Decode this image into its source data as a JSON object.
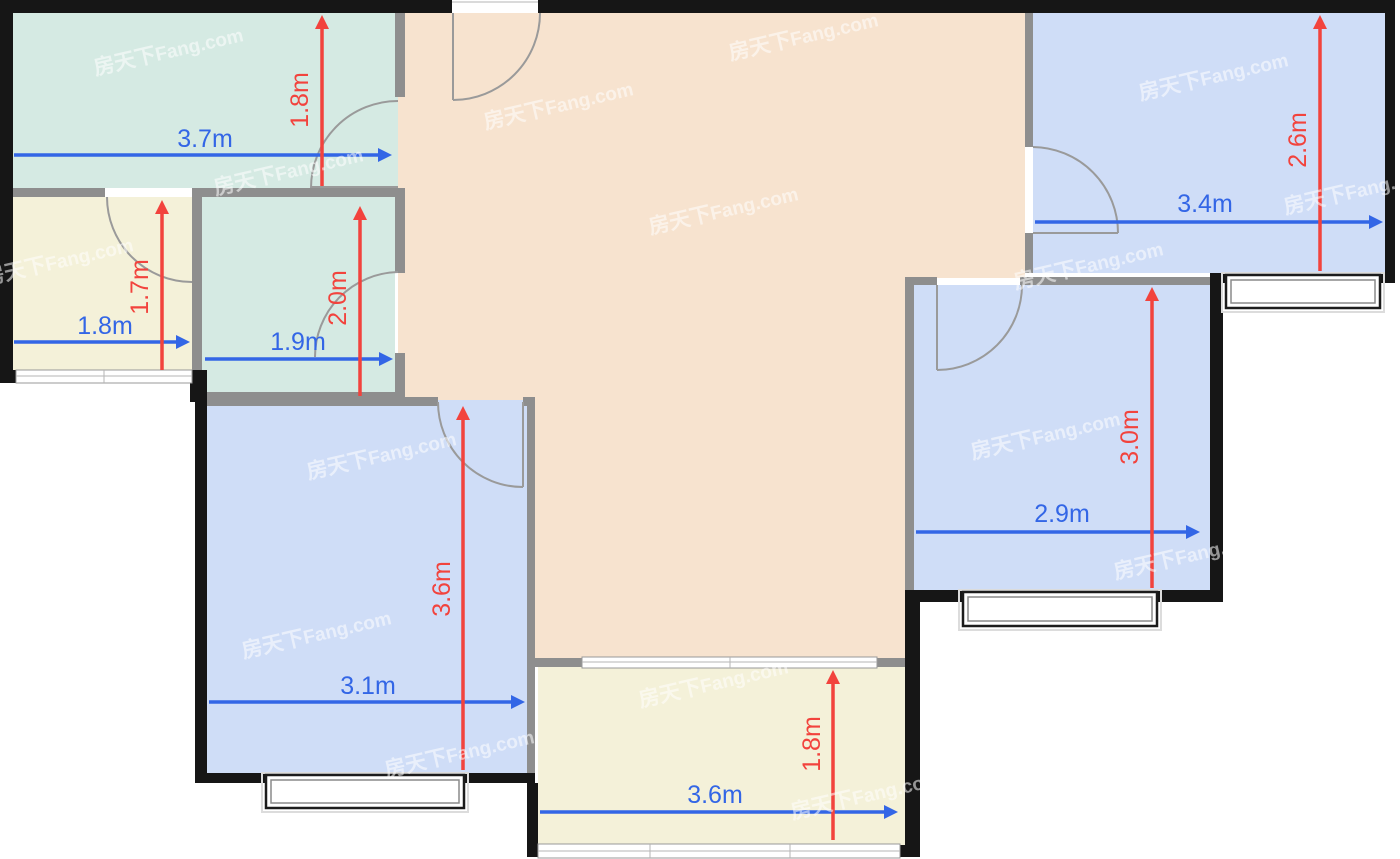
{
  "page": {
    "width_px": 1400,
    "height_px": 859,
    "background": "#ffffff"
  },
  "unit_suffix": "m",
  "colors": {
    "wall_exterior": "#161616",
    "wall_interior": "#8e8e8e",
    "room_teal": "#d5eae3",
    "room_yellow": "#f4f1d9",
    "room_peach": "#f7e3cf",
    "room_blue": "#cfddf7",
    "dim_blue": "#3366e6",
    "dim_red": "#f2433d",
    "door_arc": "#9a9a9a",
    "watermark": "#ffffff"
  },
  "watermark": {
    "text_cn": "房天下",
    "text_en": "Fang.com",
    "positions": [
      [
        170,
        58
      ],
      [
        560,
        112
      ],
      [
        805,
        43
      ],
      [
        725,
        217
      ],
      [
        1215,
        83
      ],
      [
        1360,
        197
      ],
      [
        290,
        178
      ],
      [
        60,
        268
      ],
      [
        1090,
        272
      ],
      [
        383,
        462
      ],
      [
        1047,
        442
      ],
      [
        1190,
        562
      ],
      [
        318,
        641
      ],
      [
        461,
        760
      ],
      [
        715,
        690
      ],
      [
        867,
        802
      ]
    ]
  },
  "rooms": {
    "kitchen": {
      "width_label": "3.7m",
      "height_label": "1.8m"
    },
    "bath_small": {
      "width_label": "1.8m",
      "height_label": "1.7m"
    },
    "bath_large": {
      "width_label": "1.9m",
      "height_label": "2.0m"
    },
    "bedroom_top_right": {
      "width_label": "3.4m",
      "height_label": "2.6m"
    },
    "bedroom_right": {
      "width_label": "2.9m",
      "height_label": "3.0m"
    },
    "bedroom_left": {
      "width_label": "3.1m",
      "height_label": "3.6m"
    },
    "balcony": {
      "width_label": "3.6m",
      "height_label": "1.8m"
    }
  }
}
